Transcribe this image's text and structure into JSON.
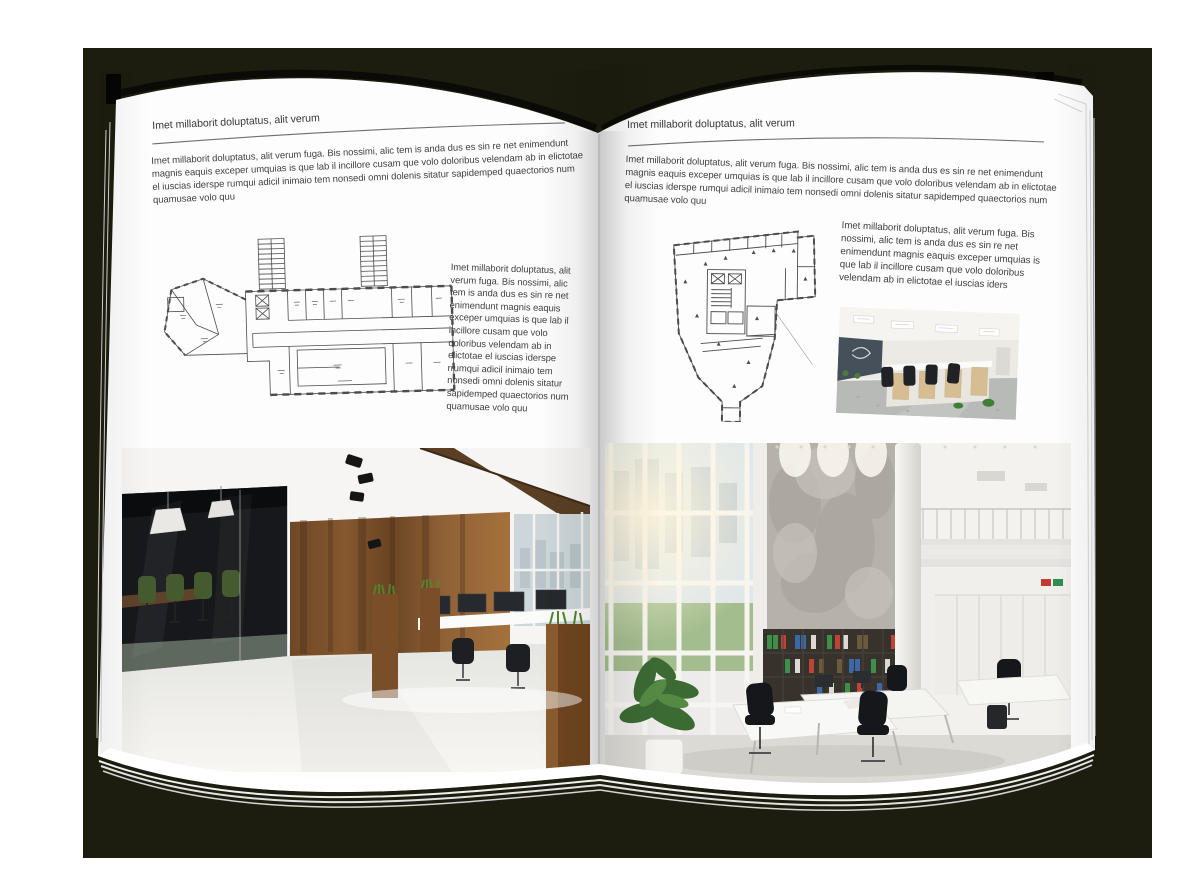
{
  "book": {
    "left_page": {
      "header": "Imet millaborit doluptatus, alit verum",
      "intro": "Imet millaborit doluptatus, alit verum fuga. Bis nossimi, alic tem is anda dus es sin re net enimendunt magnis eaquis exceper umquias is que lab il incillore cusam que volo doloribus velendam ab in elictotae el iuscias iderspe rumqui adicil inimaio tem nonsedi omni dolenis sitatur sapidemped quaectorios num quamusae volo quu",
      "side_text": "Imet millaborit doluptatus, alit verum fuga. Bis nossimi, alic tem is anda dus es sin re net enimendunt magnis eaquis exceper umquias is que lab il incillore cusam que volo doloribus velendam ab in elictotae el iuscias iderspe rrumqui adicil inimaio tem nonsedi omni dolenis sitatur sapidemped quaectorios num quamusae volo quu"
    },
    "right_page": {
      "header": "Imet millaborit doluptatus, alit verum",
      "intro": "Imet millaborit doluptatus, alit verum fuga. Bis nossimi, alic tem is anda dus es sin re net enimendunt magnis eaquis exceper umquias is que lab il incillore cusam que volo doloribus velendam ab in elictotae el iuscias iderspe rumqui adicil inimaio tem nonsedi omni dolenis sitatur sapidemped quaectorios num quamusae volo quu",
      "side_text": "Imet millaborit doluptatus, alit verum fuga. Bis nossimi, alic tem is anda dus es sin re net enimendunt magnis eaquis exceper umquias is que lab il incillore cusam que volo doloribus velendam ab in elictotae el iuscias iders"
    }
  },
  "colors": {
    "backdrop": "#1c1d0e",
    "page": "#fdfdfd",
    "ink": "#3e3e40",
    "rule_line": "#6e6e6e",
    "plan_line": "#4c4c4c",
    "wood_wall": "#7a5131",
    "grass": "#54822f",
    "glass_dark": "#16181b",
    "chair_green": "#465a2f",
    "concrete": "#b6b2aa",
    "binder_green": "#3e8f49",
    "binder_red": "#bf4438",
    "binder_blue": "#3c68a5",
    "chair_black": "#16171a",
    "plant_green": "#3c6a33"
  }
}
